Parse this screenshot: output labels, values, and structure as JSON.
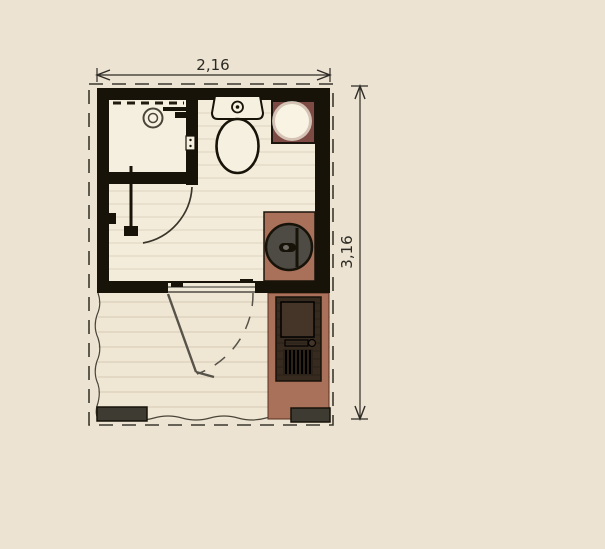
{
  "title": "bathroom-floor-plan",
  "dimensions": {
    "width_label": "2,16",
    "height_label": "3,16"
  },
  "palette": {
    "background": "#ede3d2",
    "wall": "#171309",
    "floor": "#f3ecda",
    "shower_floor": "#f5efdf",
    "deck": "#efe7d4",
    "counter_terracotta": "#a9705a",
    "counter_maroon": "#7d4a44",
    "appliance_gray": "#4d4b44",
    "step_gray": "#3d3b32",
    "unit_dark": "#372b1f",
    "line": "#2e2c26",
    "fixture_fill": "#f6f0e0"
  }
}
